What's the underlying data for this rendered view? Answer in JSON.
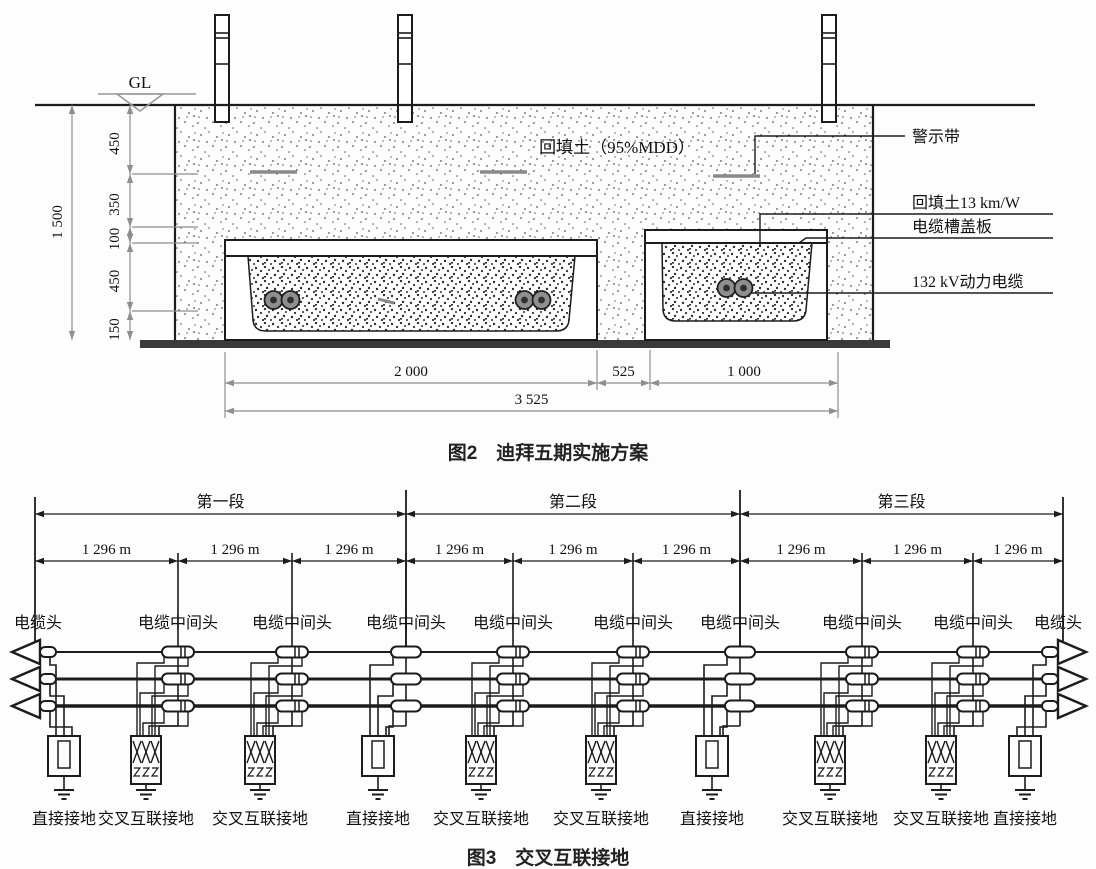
{
  "figure2": {
    "caption": "图2　迪拜五期实施方案",
    "gl_label": "GL",
    "soil_label": "回填土（95%MDD）",
    "callouts": [
      "警示带",
      "回填土13 km/W",
      "电缆槽盖板",
      "132 kV动力电缆"
    ],
    "vertical_dims": {
      "total": "1 500",
      "chain": [
        "450",
        "350",
        "100",
        "450",
        "150"
      ]
    },
    "horizontal_dims": {
      "segments": [
        "2 000",
        "525",
        "1 000"
      ],
      "total": "3 525"
    },
    "line_color": "#1c1c1c",
    "dim_color": "#8f8f8f"
  },
  "figure3": {
    "caption": "图3　交叉互联接地",
    "sections": [
      "第一段",
      "第二段",
      "第三段"
    ],
    "span_label": "1 296 m",
    "nodes": [
      {
        "label": "电缆头",
        "ground": "直接接地",
        "type": "terminal"
      },
      {
        "label": "电缆中间头",
        "ground": "交叉互联接地",
        "type": "cross"
      },
      {
        "label": "电缆中间头",
        "ground": "交叉互联接地",
        "type": "cross"
      },
      {
        "label": "电缆中间头",
        "ground": "直接接地",
        "type": "direct"
      },
      {
        "label": "电缆中间头",
        "ground": "交叉互联接地",
        "type": "cross"
      },
      {
        "label": "电缆中间头",
        "ground": "交叉互联接地",
        "type": "cross"
      },
      {
        "label": "电缆中间头",
        "ground": "直接接地",
        "type": "direct"
      },
      {
        "label": "电缆中间头",
        "ground": "交叉互联接地",
        "type": "cross"
      },
      {
        "label": "电缆中间头",
        "ground": "交叉互联接地",
        "type": "cross"
      },
      {
        "label": "电缆头",
        "ground": "直接接地",
        "type": "terminal"
      }
    ]
  }
}
